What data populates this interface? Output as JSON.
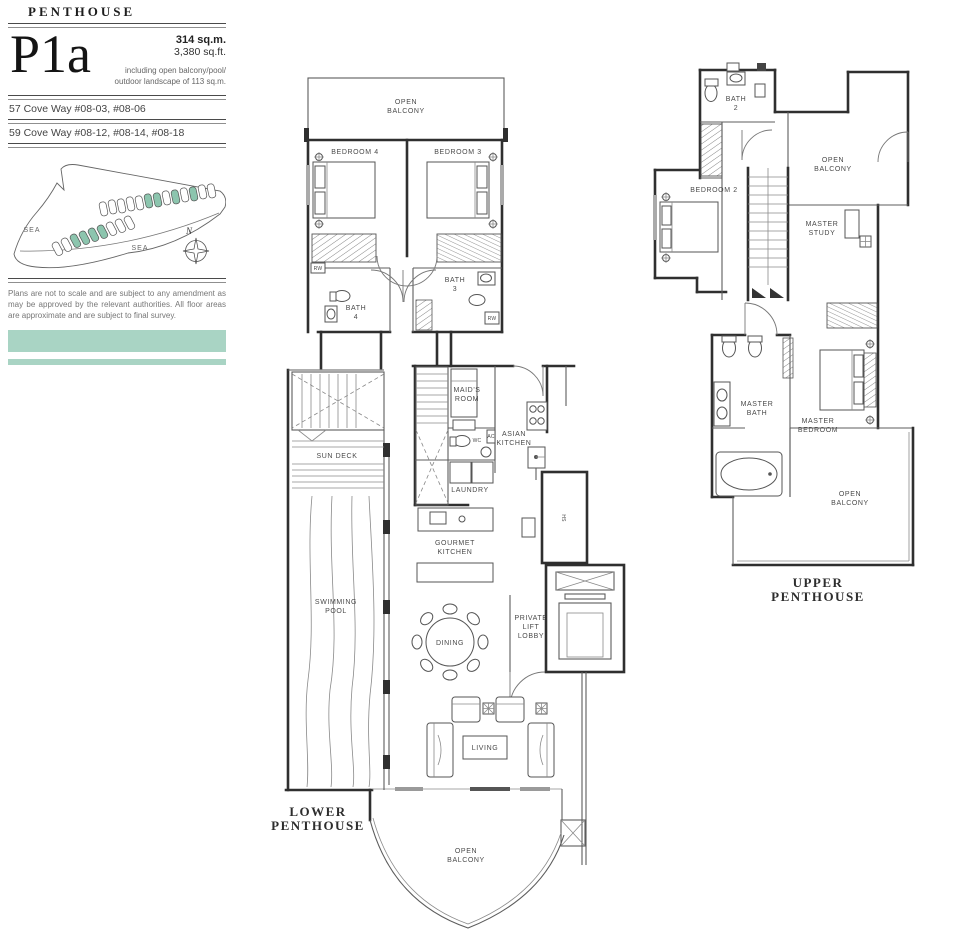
{
  "header": {
    "category": "PENTHOUSE",
    "unit": "P1a",
    "area_sqm": "314 sq.m.",
    "area_sqft": "3,380 sq.ft.",
    "area_note_line1": "including open balcony/pool/",
    "area_note_line2": "outdoor landscape of 113 sq.m.",
    "address_line1": "57 Cove Way #08-03, #08-06",
    "address_line2": "59 Cove Way #08-12, #08-14, #08-18",
    "disclaimer": "Plans are not to scale and are subject to any amendment as may be approved by the relevant authorities. All floor areas are approximate and are subject to final survey.",
    "accent_color": "#a9d4c4",
    "site_highlight_color": "#8cc5ae"
  },
  "site_plan": {
    "sea_left": "SEA",
    "sea_right": "SEA",
    "north": "N"
  },
  "lower_plan": {
    "title": [
      "LOWER",
      "PENTHOUSE"
    ],
    "labels": {
      "open_balcony_top": [
        "OPEN",
        "BALCONY"
      ],
      "bedroom4": "BEDROOM 4",
      "bedroom3": "BEDROOM 3",
      "bath4": [
        "BATH",
        "4"
      ],
      "bath3": [
        "BATH",
        "3"
      ],
      "rw_left": "RW",
      "rw_right": "RW",
      "maids_room": [
        "MAID'S",
        "ROOM"
      ],
      "wc": "WC",
      "ac": "AC",
      "asian_kitchen": [
        "ASIAN",
        "KITCHEN"
      ],
      "laundry": "LAUNDRY",
      "sun_deck": "SUN DECK",
      "gourmet_kitchen": [
        "GOURMET",
        "KITCHEN"
      ],
      "swimming_pool": [
        "SWIMMING",
        "POOL"
      ],
      "dining": "DINING",
      "private_lift_lobby": [
        "PRIVATE",
        "LIFT",
        "LOBBY"
      ],
      "hs": "HS",
      "living": "LIVING",
      "open_balcony_bottom": [
        "OPEN",
        "BALCONY"
      ]
    }
  },
  "upper_plan": {
    "title": [
      "UPPER",
      "PENTHOUSE"
    ],
    "labels": {
      "bath2": [
        "BATH",
        "2"
      ],
      "bedroom2": "BEDROOM 2",
      "open_balcony_top": [
        "OPEN",
        "BALCONY"
      ],
      "master_study": [
        "MASTER",
        "STUDY"
      ],
      "master_bath": [
        "MASTER",
        "BATH"
      ],
      "master_bedroom": [
        "MASTER",
        "BEDROOM"
      ],
      "open_balcony_bottom": [
        "OPEN",
        "BALCONY"
      ]
    }
  }
}
